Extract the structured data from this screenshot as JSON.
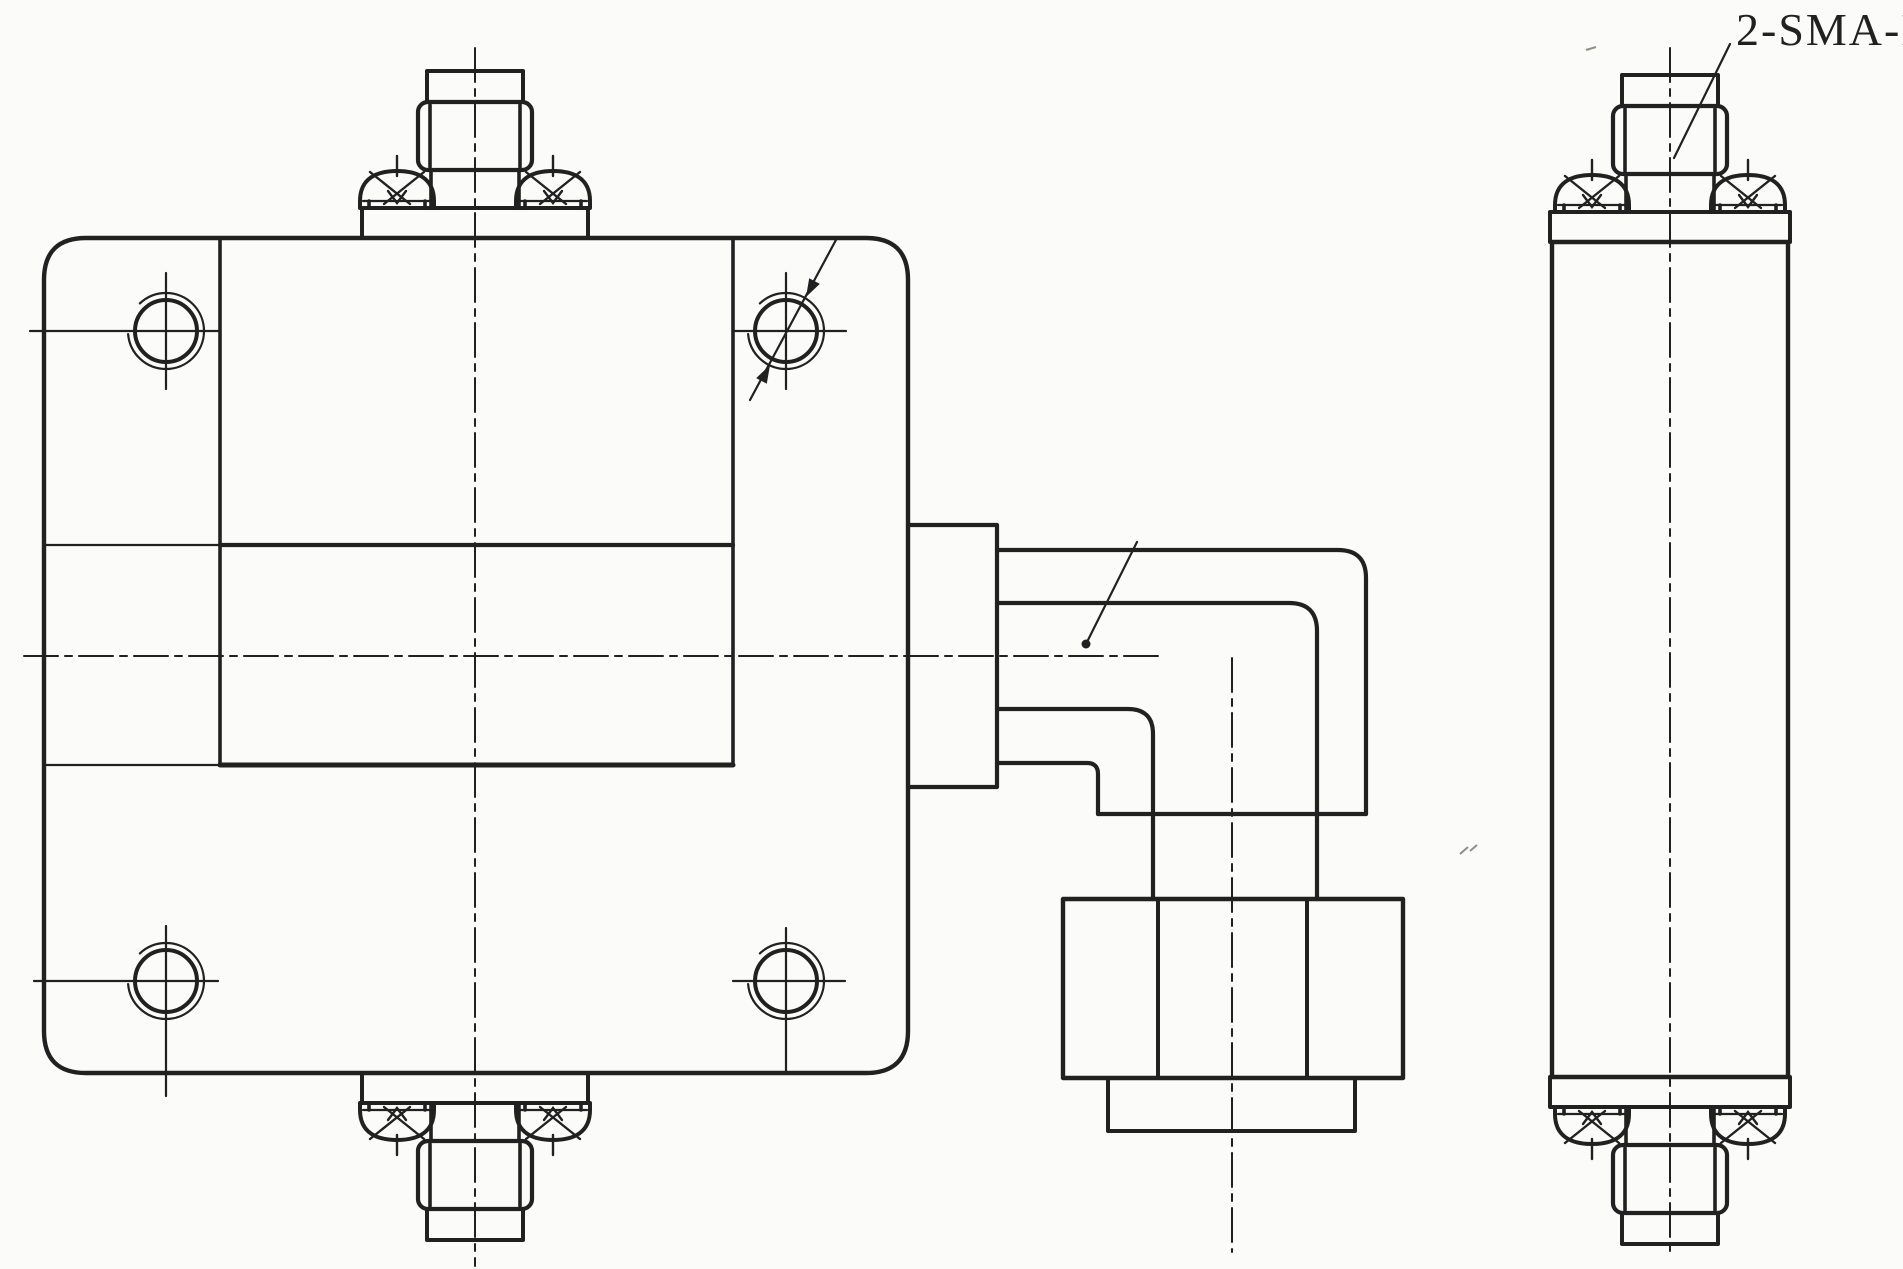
{
  "annotation": {
    "connector_callout": "2-SMA-K"
  },
  "colors": {
    "ink": "#212121",
    "paper": "#fbfbf9",
    "speck": "#8f8f87"
  }
}
